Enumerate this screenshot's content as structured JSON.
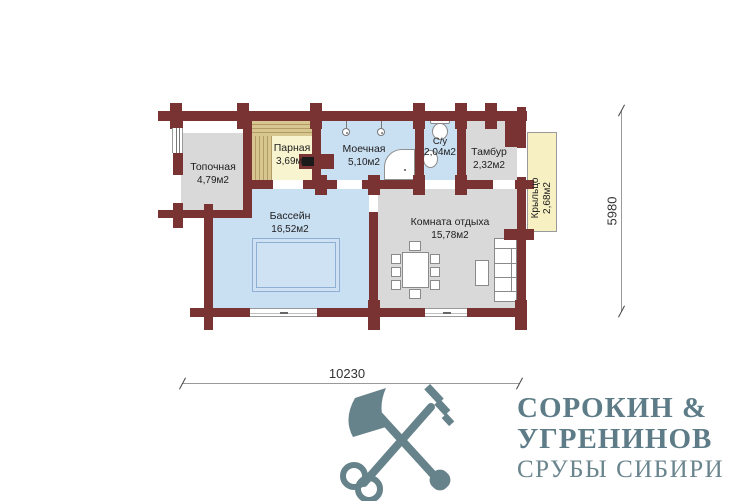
{
  "plan": {
    "rooms": [
      {
        "name": "Топочная",
        "area": "4,79м2"
      },
      {
        "name": "Парная",
        "area": "3,69м2"
      },
      {
        "name": "Моечная",
        "area": "5,10м2"
      },
      {
        "name": "С/у",
        "area": "2,04м2"
      },
      {
        "name": "Тамбур",
        "area": "2,32м2"
      },
      {
        "name": "Бассейн",
        "area": "16,52м2"
      },
      {
        "name": "Комната отдыха",
        "area": "15,78м2"
      },
      {
        "name": "Крыльцо",
        "area": "2,68м2"
      }
    ],
    "dimensions": {
      "width": "10230",
      "height": "5980"
    }
  },
  "logo": {
    "line1": "СОРОКИН &",
    "line2": "УГРЕНИНОВ",
    "line3": "СРУБЫ СИБИРИ"
  },
  "colors": {
    "wall": "#7a3333",
    "room_gray": "#d9d9d9",
    "room_blue": "#c9dff2",
    "room_yellow": "#f8f4d0",
    "porch_yellow": "#f6f0c3",
    "bench": "#d8c690",
    "pool_fill": "#cfe2f4",
    "pool_line": "#8fafd2",
    "logo": "#66828b"
  }
}
